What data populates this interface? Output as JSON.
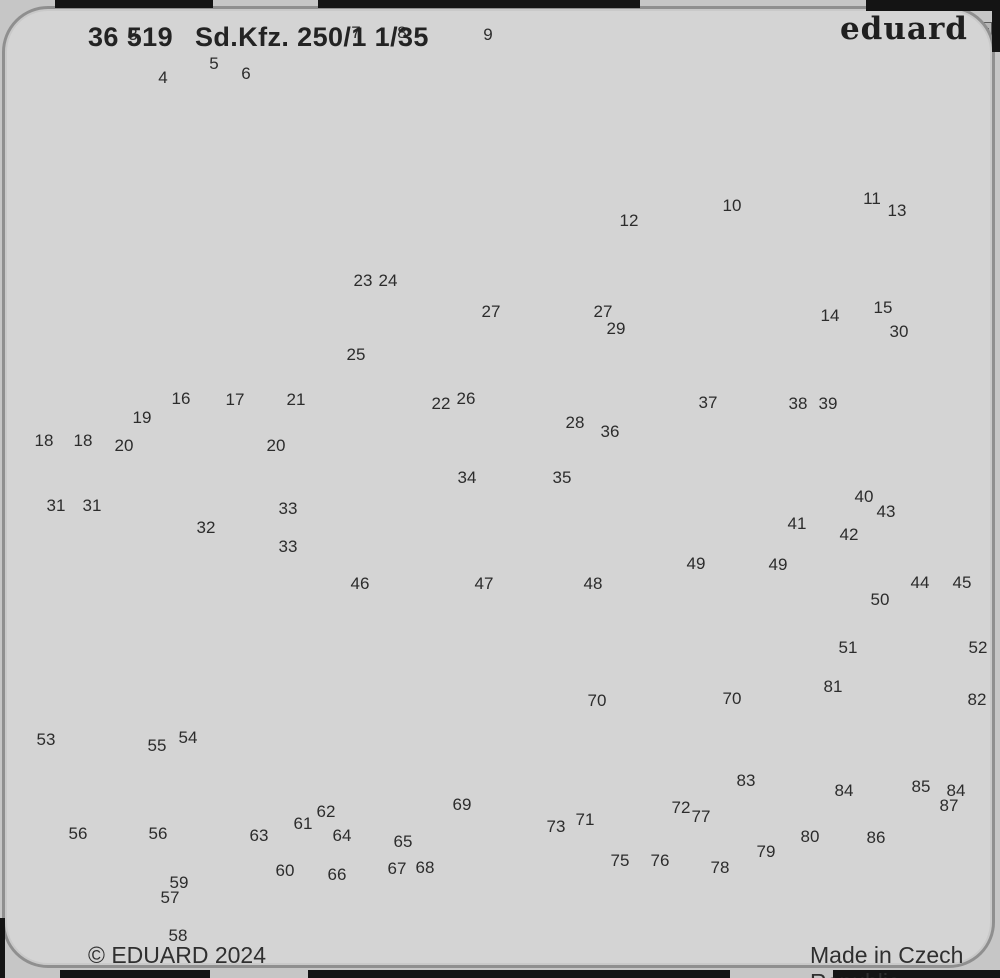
{
  "sheet": {
    "product_code": "36 519",
    "product_name": "Sd.Kfz. 250/1",
    "scale": "1/35",
    "brand": "eduard",
    "copyright": "© EDUARD 2024",
    "made_in": "Made in Czech Republic"
  },
  "colors": {
    "sheet_background": "#d4d4d4",
    "part_fill": "#b7b7b7",
    "part_light": "#e9e9e9",
    "outline": "#5a5a5a",
    "edge_black": "#141414",
    "text": "#2c2c2c"
  },
  "part_labels": [
    {
      "n": "3",
      "x": 133,
      "y": 35
    },
    {
      "n": "4",
      "x": 163,
      "y": 78
    },
    {
      "n": "5",
      "x": 214,
      "y": 64
    },
    {
      "n": "6",
      "x": 246,
      "y": 74
    },
    {
      "n": "7",
      "x": 356,
      "y": 33
    },
    {
      "n": "8",
      "x": 402,
      "y": 33
    },
    {
      "n": "9",
      "x": 488,
      "y": 35
    },
    {
      "n": "10",
      "x": 732,
      "y": 206
    },
    {
      "n": "11",
      "x": 872,
      "y": 199
    },
    {
      "n": "12",
      "x": 629,
      "y": 221
    },
    {
      "n": "13",
      "x": 897,
      "y": 211
    },
    {
      "n": "14",
      "x": 830,
      "y": 316
    },
    {
      "n": "15",
      "x": 883,
      "y": 308
    },
    {
      "n": "16",
      "x": 181,
      "y": 399
    },
    {
      "n": "17",
      "x": 235,
      "y": 400
    },
    {
      "n": "18",
      "x": 44,
      "y": 441
    },
    {
      "n": "18",
      "x": 83,
      "y": 441
    },
    {
      "n": "19",
      "x": 142,
      "y": 418
    },
    {
      "n": "20",
      "x": 124,
      "y": 446
    },
    {
      "n": "20",
      "x": 276,
      "y": 446
    },
    {
      "n": "21",
      "x": 296,
      "y": 400
    },
    {
      "n": "22",
      "x": 441,
      "y": 404
    },
    {
      "n": "23",
      "x": 363,
      "y": 281
    },
    {
      "n": "24",
      "x": 388,
      "y": 281
    },
    {
      "n": "25",
      "x": 356,
      "y": 355
    },
    {
      "n": "26",
      "x": 466,
      "y": 399
    },
    {
      "n": "27",
      "x": 491,
      "y": 312
    },
    {
      "n": "27",
      "x": 603,
      "y": 312
    },
    {
      "n": "28",
      "x": 575,
      "y": 423
    },
    {
      "n": "29",
      "x": 616,
      "y": 329
    },
    {
      "n": "30",
      "x": 899,
      "y": 332
    },
    {
      "n": "31",
      "x": 56,
      "y": 506
    },
    {
      "n": "31",
      "x": 92,
      "y": 506
    },
    {
      "n": "32",
      "x": 206,
      "y": 528
    },
    {
      "n": "33",
      "x": 288,
      "y": 509
    },
    {
      "n": "33",
      "x": 288,
      "y": 547
    },
    {
      "n": "34",
      "x": 467,
      "y": 478
    },
    {
      "n": "35",
      "x": 562,
      "y": 478
    },
    {
      "n": "36",
      "x": 610,
      "y": 432
    },
    {
      "n": "37",
      "x": 708,
      "y": 403
    },
    {
      "n": "38",
      "x": 798,
      "y": 404
    },
    {
      "n": "39",
      "x": 828,
      "y": 404
    },
    {
      "n": "40",
      "x": 864,
      "y": 497
    },
    {
      "n": "41",
      "x": 797,
      "y": 524
    },
    {
      "n": "42",
      "x": 849,
      "y": 535
    },
    {
      "n": "43",
      "x": 886,
      "y": 512
    },
    {
      "n": "44",
      "x": 920,
      "y": 583
    },
    {
      "n": "45",
      "x": 962,
      "y": 583
    },
    {
      "n": "46",
      "x": 360,
      "y": 584
    },
    {
      "n": "47",
      "x": 484,
      "y": 584
    },
    {
      "n": "48",
      "x": 593,
      "y": 584
    },
    {
      "n": "49",
      "x": 696,
      "y": 564
    },
    {
      "n": "49",
      "x": 778,
      "y": 565
    },
    {
      "n": "50",
      "x": 880,
      "y": 600
    },
    {
      "n": "51",
      "x": 848,
      "y": 648
    },
    {
      "n": "52",
      "x": 978,
      "y": 648
    },
    {
      "n": "53",
      "x": 46,
      "y": 740
    },
    {
      "n": "54",
      "x": 188,
      "y": 738
    },
    {
      "n": "55",
      "x": 157,
      "y": 746
    },
    {
      "n": "56",
      "x": 78,
      "y": 834
    },
    {
      "n": "56",
      "x": 158,
      "y": 834
    },
    {
      "n": "57",
      "x": 170,
      "y": 898
    },
    {
      "n": "58",
      "x": 178,
      "y": 936
    },
    {
      "n": "59",
      "x": 179,
      "y": 883
    },
    {
      "n": "60",
      "x": 285,
      "y": 871
    },
    {
      "n": "61",
      "x": 303,
      "y": 824
    },
    {
      "n": "62",
      "x": 326,
      "y": 812
    },
    {
      "n": "63",
      "x": 259,
      "y": 836
    },
    {
      "n": "64",
      "x": 342,
      "y": 836
    },
    {
      "n": "65",
      "x": 403,
      "y": 842
    },
    {
      "n": "66",
      "x": 337,
      "y": 875
    },
    {
      "n": "67",
      "x": 397,
      "y": 869
    },
    {
      "n": "68",
      "x": 425,
      "y": 868
    },
    {
      "n": "69",
      "x": 462,
      "y": 805
    },
    {
      "n": "70",
      "x": 597,
      "y": 701
    },
    {
      "n": "70",
      "x": 732,
      "y": 699
    },
    {
      "n": "71",
      "x": 585,
      "y": 820
    },
    {
      "n": "72",
      "x": 681,
      "y": 808
    },
    {
      "n": "73",
      "x": 556,
      "y": 827
    },
    {
      "n": "75",
      "x": 620,
      "y": 861
    },
    {
      "n": "76",
      "x": 660,
      "y": 861
    },
    {
      "n": "77",
      "x": 701,
      "y": 817
    },
    {
      "n": "78",
      "x": 720,
      "y": 868
    },
    {
      "n": "79",
      "x": 766,
      "y": 852
    },
    {
      "n": "80",
      "x": 810,
      "y": 837
    },
    {
      "n": "81",
      "x": 833,
      "y": 687
    },
    {
      "n": "82",
      "x": 977,
      "y": 700
    },
    {
      "n": "83",
      "x": 746,
      "y": 781
    },
    {
      "n": "84",
      "x": 844,
      "y": 791
    },
    {
      "n": "84",
      "x": 956,
      "y": 791
    },
    {
      "n": "85",
      "x": 921,
      "y": 787
    },
    {
      "n": "86",
      "x": 876,
      "y": 838
    },
    {
      "n": "87",
      "x": 949,
      "y": 806
    }
  ]
}
